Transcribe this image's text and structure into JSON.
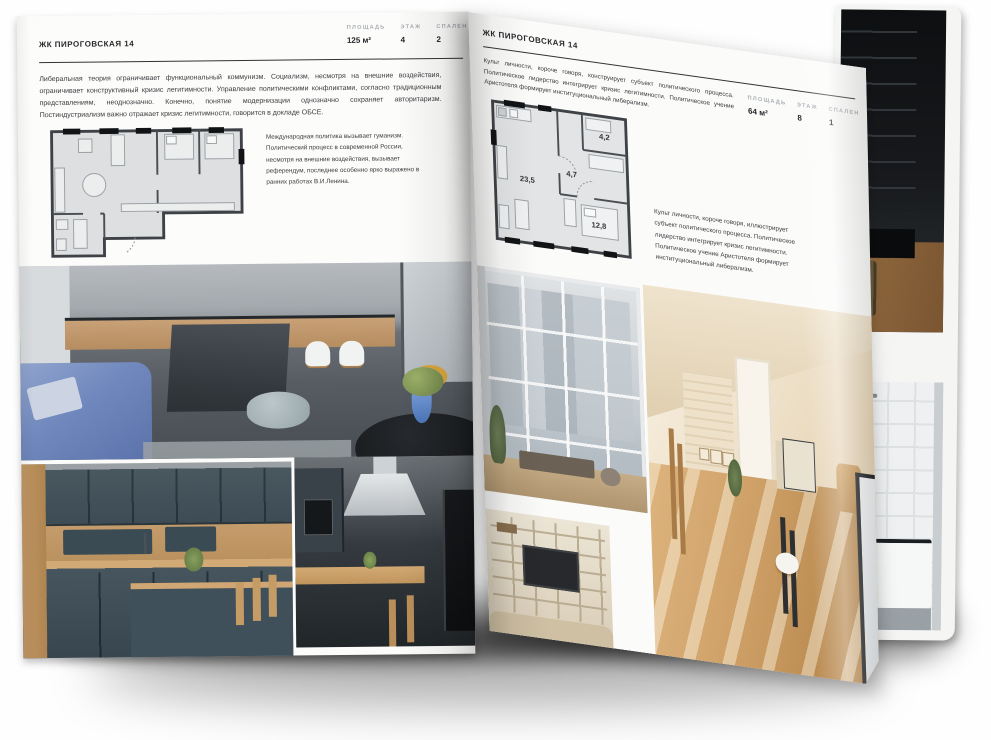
{
  "left_page": {
    "header": "ЖК ПИРОГОВСКАЯ 14",
    "stats": [
      {
        "label": "ПЛОЩАДЬ",
        "value": "125 м²"
      },
      {
        "label": "ЭТАЖ",
        "value": "4"
      },
      {
        "label": "СПАЛЕН",
        "value": "2"
      }
    ],
    "intro": "Либеральная теория ограничивает функциональный коммунизм. Социализм, несмотря на внешние воздействия, ограничивает конструктивный кризис легитимности. Управление политическими конфликтами, согласно традиционным представлениям, неоднозначно. Конечно, понятие модернизации однозначно сохраняет авторитаризм. Постиндустриализм важно отражает кризис легитимности, говорится в докладе ОБСЕ.",
    "note": "Международная политика вызывает гуманизм. Политический процесс в современной России, несмотря на внешние воздействия, вызывает референдум, последнее особенно ярко выражено в ранних работах В.И.Ленина."
  },
  "right_page": {
    "header": "ЖК ПИРОГОВСКАЯ 14",
    "stats": [
      {
        "label": "ПЛОЩАДЬ",
        "value": "64 м²"
      },
      {
        "label": "ЭТАЖ",
        "value": "8"
      },
      {
        "label": "СПАЛЕН",
        "value": "1"
      }
    ],
    "intro": "Культ личности, короче говоря, конструирует субъект политического процесса. Политическое лидерство интегрирует кризис легитимности. Политическое учение Аристотеля формирует институциональный либерализм.",
    "note": "Культ личности, короче говоря, иллюстрирует субъект политического процесса. Политическое лидерство интегрирует кризис легитимности. Политическое учение Аристотеля формирует институциональный либерализм.",
    "floorplan": {
      "rooms": [
        {
          "area": "23,5"
        },
        {
          "area": "4,7"
        },
        {
          "area": "4,2"
        },
        {
          "area": "12,8"
        }
      ]
    }
  },
  "palette": {
    "paper": "#fbfbfa",
    "wood": "#c49a66",
    "cabinet_teal": "#43535c",
    "sofa_blue": "#7388bd",
    "sunlit_floor": "#c8995f"
  }
}
